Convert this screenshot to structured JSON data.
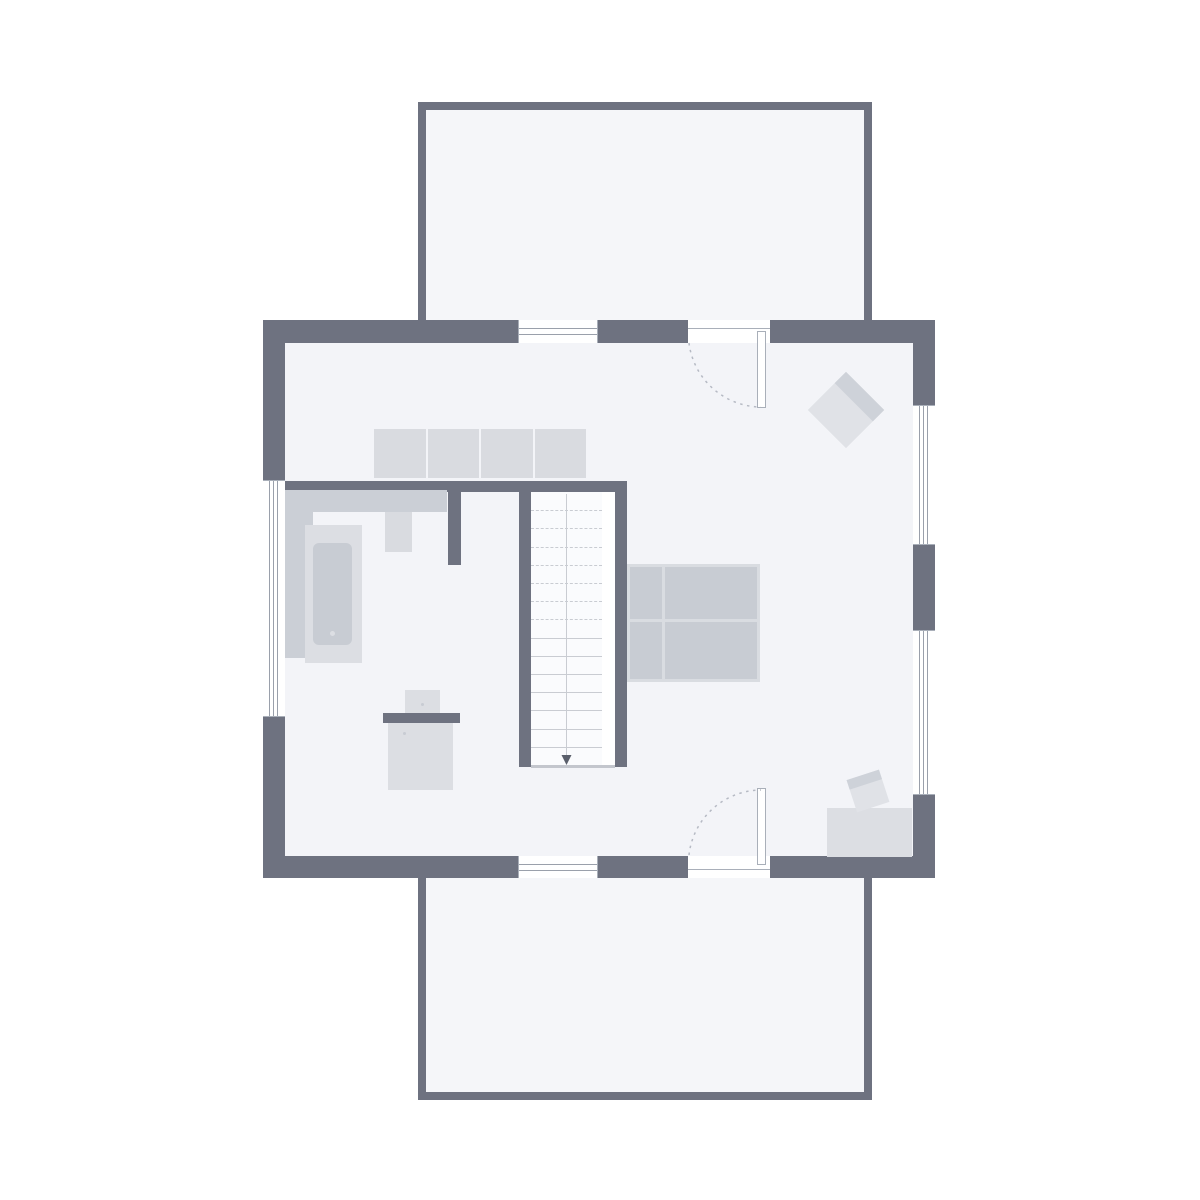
{
  "canvas": {
    "width": 1200,
    "height": 1200,
    "background": "#ffffff"
  },
  "drawing": {
    "kind": "architectural floor plan, top view, no text labels",
    "areas": [
      "balcony",
      "main-floor",
      "terrace",
      "bathroom-corner",
      "stairwell"
    ],
    "furniture_legend": [
      "wardrobe",
      "bathroom-counter",
      "washbasin",
      "bathtub",
      "washstand-unit",
      "double-bed",
      "armchair",
      "desk",
      "desk-chair",
      "staircase-down"
    ]
  },
  "palette": {
    "canvas_bg": "#ffffff",
    "wall": "#6e7280",
    "floor": "#f3f4f8",
    "outdoor_floor": "#f5f6f9",
    "stair_floor": "#fafbfd",
    "furniture_light": "#dcdee3",
    "furniture_shade": "#d9dbe0",
    "furniture_mid": "#c8ccd3",
    "counter": "#cbcfd6",
    "seat_body": "#e0e2e7",
    "seat_back": "#ced2d9",
    "bed_frame": "#d9dce1",
    "window_line": "#9aa0ab",
    "door_line": "#a9afb9",
    "dash_line": "#b6bac4",
    "tread_line": "#c9ccd2",
    "arrow": "#5a5f6b"
  },
  "staircase": {
    "dashed_treads": 7,
    "solid_treads": 7,
    "direction": "down"
  },
  "wardrobe": {
    "segments": 4
  },
  "windows": {
    "horizontal_panes": 2,
    "vertical_panes": 3
  }
}
